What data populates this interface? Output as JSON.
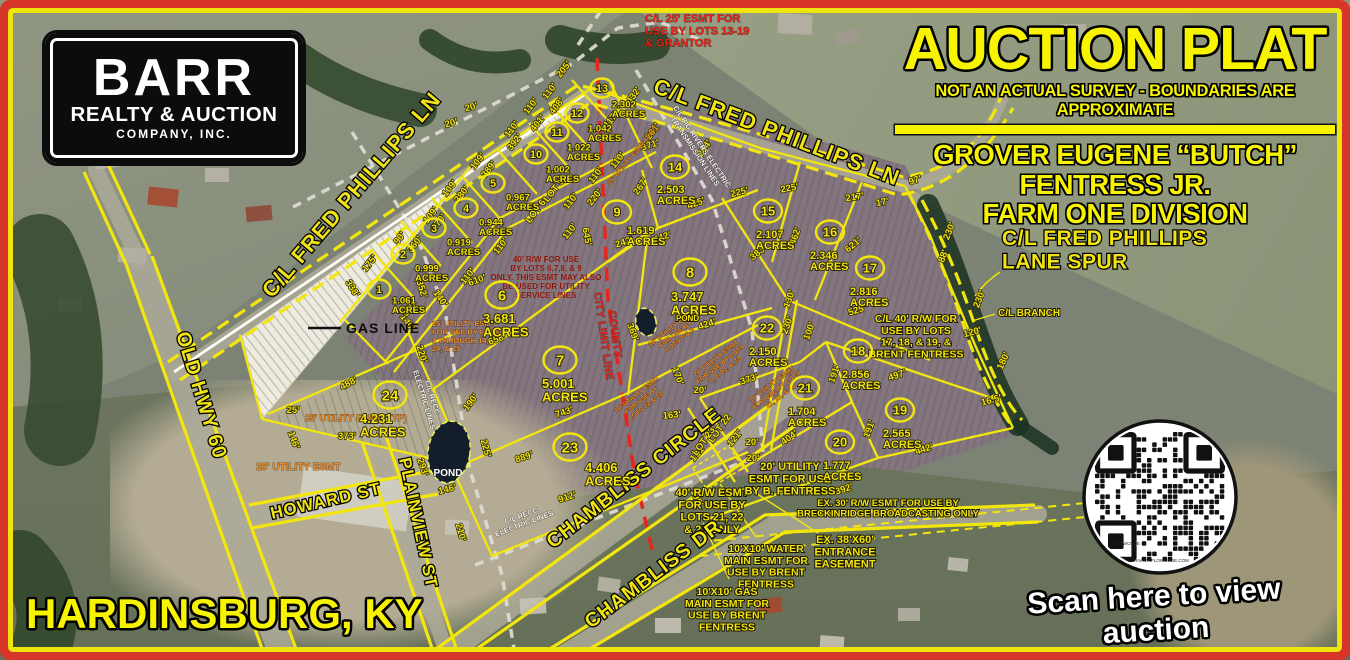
{
  "frame": {
    "border_color": "#d8352a",
    "inner_border_color": "#efe40c"
  },
  "logo": {
    "line1": "BARR",
    "line2": "REALTY & AUCTION",
    "line3": "COMPANY, INC."
  },
  "title_block": {
    "title": "AUCTION PLAT",
    "subtitle": "NOT AN ACTUAL SURVEY - BOUNDARIES ARE APPROXIMATE",
    "owner_line1": "GROVER EUGENE “BUTCH” FENTRESS JR.",
    "owner_line2": "FARM ONE DIVISION",
    "accent_color": "#f8f400"
  },
  "labels": {
    "city": "HARDINSBURG, KY",
    "scan_caption": "Scan here to view auction",
    "qr_brand": "FLOWCODE",
    "qr_privacy": "PRIVACY.FLOWCODE.COM"
  },
  "road_labels": [
    [
      "C/L FRED PHILLIPS LN",
      272,
      299,
      -49.5,
      22
    ],
    [
      "C/L FRED PHILLIPS LN",
      652,
      92,
      21,
      22
    ],
    [
      "OLD HWY 60",
      176,
      334,
      73,
      20
    ],
    [
      "HOWARD ST",
      272,
      519,
      -13,
      17
    ],
    [
      "PLAINVIEW ST",
      399,
      459,
      78,
      17
    ],
    [
      "CHAMBLISS CIRCLE",
      553,
      549,
      -38,
      20
    ],
    [
      "CHAMBLISS DR",
      591,
      629,
      -37,
      20
    ]
  ],
  "lots": [
    [
      "1",
      "1.061",
      379,
      289,
      392,
      294,
      "s"
    ],
    [
      "2",
      "0.999",
      403,
      254,
      415,
      262,
      "s"
    ],
    [
      "3",
      "0.919",
      434,
      228,
      447,
      236,
      "s"
    ],
    [
      "4",
      "0.944",
      466,
      208,
      479,
      216,
      "s"
    ],
    [
      "5",
      "0.967",
      493,
      183,
      506,
      191,
      "s"
    ],
    [
      "6",
      "3.681",
      502,
      295,
      483,
      310,
      "b"
    ],
    [
      "7",
      "5.001",
      560,
      360,
      542,
      375,
      "b"
    ],
    [
      "8",
      "3.747",
      690,
      272,
      671,
      288,
      "b"
    ],
    [
      "9",
      "1.619",
      617,
      212,
      627,
      223,
      "m"
    ],
    [
      "10",
      "1.002",
      536,
      154,
      546,
      163,
      "s"
    ],
    [
      "11",
      "1.022",
      557,
      132,
      567,
      141,
      "s"
    ],
    [
      "12",
      "1.042",
      577,
      113,
      588,
      122,
      "s"
    ],
    [
      "13",
      "2.302",
      602,
      88,
      612,
      98,
      "s"
    ],
    [
      "14",
      "2.503",
      675,
      167,
      657,
      182,
      "m"
    ],
    [
      "15",
      "2.107",
      768,
      211,
      756,
      227,
      "m"
    ],
    [
      "16",
      "2.346",
      830,
      232,
      810,
      248,
      "m"
    ],
    [
      "17",
      "2.816",
      870,
      268,
      850,
      284,
      "m"
    ],
    [
      "18",
      "2.856",
      858,
      351,
      842,
      367,
      "m"
    ],
    [
      "19",
      "2.565",
      900,
      410,
      883,
      426,
      "m"
    ],
    [
      "20",
      "1.777",
      840,
      442,
      823,
      458,
      "m"
    ],
    [
      "21",
      "1.704",
      805,
      388,
      788,
      404,
      "m"
    ],
    [
      "22",
      "2.150",
      767,
      328,
      749,
      344,
      "m"
    ],
    [
      "23",
      "4.406",
      570,
      447,
      585,
      459,
      "b"
    ],
    [
      "24",
      "4.231",
      390,
      395,
      360,
      410,
      "b"
    ]
  ],
  "dims": [
    [
      "20'",
      472,
      110,
      -15
    ],
    [
      "20'",
      452,
      126,
      -15
    ],
    [
      "205'",
      566,
      71,
      -52
    ],
    [
      "175'",
      372,
      265,
      -52
    ],
    [
      "338'",
      350,
      290,
      58
    ],
    [
      "90'",
      402,
      240,
      -52
    ],
    [
      "360'",
      417,
      246,
      -52
    ],
    [
      "352'",
      419,
      290,
      72
    ],
    [
      "140'",
      405,
      324,
      55
    ],
    [
      "140'",
      438,
      300,
      55
    ],
    [
      "220'",
      419,
      355,
      72
    ],
    [
      "488'",
      350,
      386,
      -28
    ],
    [
      "25'",
      293,
      413,
      0
    ],
    [
      "146'",
      291,
      441,
      70
    ],
    [
      "373'",
      347,
      439,
      0
    ],
    [
      "293'",
      420,
      468,
      72
    ],
    [
      "109'",
      433,
      217,
      -52
    ],
    [
      "370'",
      441,
      224,
      -52
    ],
    [
      "109'",
      452,
      190,
      -52
    ],
    [
      "380'",
      464,
      196,
      -52
    ],
    [
      "109'",
      480,
      163,
      -52
    ],
    [
      "389'",
      491,
      171,
      -52
    ],
    [
      "110'",
      514,
      131,
      -52
    ],
    [
      "392'",
      517,
      144,
      -52
    ],
    [
      "110'",
      533,
      108,
      -52
    ],
    [
      "401'",
      540,
      125,
      -52
    ],
    [
      "110'",
      552,
      93,
      -52
    ],
    [
      "408'",
      559,
      108,
      -52
    ],
    [
      "417'",
      613,
      122,
      -52
    ],
    [
      "432'",
      636,
      97,
      -55
    ],
    [
      "261'",
      655,
      133,
      -55
    ],
    [
      "371'",
      651,
      148,
      -18
    ],
    [
      "294'",
      707,
      150,
      -55
    ],
    [
      "110'",
      620,
      162,
      -52
    ],
    [
      "110'",
      598,
      177,
      -52
    ],
    [
      "220'",
      597,
      199,
      -52
    ],
    [
      "110'",
      573,
      203,
      -52
    ],
    [
      "110'",
      572,
      233,
      -52
    ],
    [
      "645'",
      584,
      237,
      80
    ],
    [
      "242'",
      625,
      245,
      -18
    ],
    [
      "110'",
      503,
      248,
      -52
    ],
    [
      "110'",
      470,
      278,
      -52
    ],
    [
      "610'",
      478,
      283,
      -20
    ],
    [
      "140'",
      412,
      310,
      -52
    ],
    [
      "658'",
      498,
      342,
      -20
    ],
    [
      "190'",
      473,
      404,
      -52
    ],
    [
      "225'",
      483,
      449,
      75
    ],
    [
      "210'",
      458,
      533,
      75
    ],
    [
      "146'",
      448,
      492,
      -15
    ],
    [
      "889'",
      525,
      460,
      -18
    ],
    [
      "912'",
      568,
      500,
      -18
    ],
    [
      "743'",
      565,
      415,
      -18
    ],
    [
      "369'",
      630,
      333,
      70
    ],
    [
      "424'",
      708,
      327,
      -18
    ],
    [
      "425'",
      697,
      206,
      -20
    ],
    [
      "267'",
      643,
      188,
      -55
    ],
    [
      "442'",
      663,
      240,
      -18
    ],
    [
      "225'",
      740,
      195,
      -14
    ],
    [
      "225'",
      790,
      191,
      -10
    ],
    [
      "217'",
      855,
      200,
      -8
    ],
    [
      "17'",
      883,
      205,
      -12
    ],
    [
      "97'",
      916,
      183,
      -18
    ],
    [
      "462'",
      798,
      237,
      -70
    ],
    [
      "383'",
      760,
      255,
      -40
    ],
    [
      "621'",
      855,
      247,
      -40
    ],
    [
      "130'",
      792,
      300,
      -70
    ],
    [
      "230'",
      790,
      326,
      -70
    ],
    [
      "100'",
      812,
      332,
      -70
    ],
    [
      "525'",
      858,
      313,
      -18
    ],
    [
      "230'",
      952,
      232,
      -68
    ],
    [
      "88'",
      946,
      257,
      -70
    ],
    [
      "230'",
      982,
      300,
      -68
    ],
    [
      "120'",
      973,
      335,
      -15
    ],
    [
      "180'",
      1006,
      362,
      -65
    ],
    [
      "16.5'",
      992,
      403,
      -15
    ],
    [
      "373'",
      750,
      382,
      -18
    ],
    [
      "404'",
      791,
      440,
      -35
    ],
    [
      "191'",
      837,
      375,
      -70
    ],
    [
      "191'",
      872,
      430,
      -70
    ],
    [
      "497'",
      898,
      378,
      -18
    ],
    [
      "442'",
      925,
      452,
      -18
    ],
    [
      "392'",
      845,
      492,
      -18
    ],
    [
      "121'",
      737,
      440,
      -50
    ],
    [
      "121'",
      700,
      455,
      -50
    ],
    [
      "163'",
      672,
      418,
      -5
    ],
    [
      "170'",
      675,
      377,
      70
    ],
    [
      "195'",
      694,
      499,
      65
    ],
    [
      "20'",
      700,
      393,
      0
    ],
    [
      "20'",
      752,
      445,
      0
    ],
    [
      "20'",
      753,
      461,
      0
    ],
    [
      "LOT 9",
      556,
      192,
      -52
    ],
    [
      "LOT 6",
      538,
      213,
      -52
    ],
    [
      "LOT 22",
      722,
      430,
      -55
    ],
    [
      "LOT 23",
      706,
      443,
      -55
    ]
  ],
  "notes": [
    {
      "t": "C/L 25' ESMT FOR\nUSE BY LOTS 13-19\n& GRANTOR",
      "x": 645,
      "y": 22,
      "cls": "red",
      "size": 11,
      "anchor": "start"
    },
    {
      "t": "40' R/W FOR USE\nBY LOTS 6,7,8, & 9\nONLY. THIS ESMT MAY ALSO\nBE USED FOR UTILITY\nSERVICE LINES",
      "x": 546,
      "y": 262,
      "cls": "darkred",
      "size": 8,
      "anchor": "middle"
    },
    {
      "t": "25' UTILITY ESMT\nFOR USE BY LOTS\n1 THROUGH 14,\n24, & 25",
      "x": 432,
      "y": 326,
      "cls": "orange",
      "size": 7.5,
      "anchor": "start"
    },
    {
      "t": "25' UTILITY ESMT (TYP)",
      "x": 305,
      "y": 421,
      "cls": "orange",
      "size": 9,
      "anchor": "start"
    },
    {
      "t": "25' UTILITY ESMT",
      "x": 256,
      "y": 470,
      "cls": "orange",
      "size": 10,
      "anchor": "start"
    },
    {
      "t": "10' UTILITY ESMT\nFOR USE BY\nLOTS 7 & 8",
      "x": 672,
      "y": 330,
      "cls": "orange",
      "size": 6.5,
      "rot": -38,
      "anchor": "middle"
    },
    {
      "t": "20' UTILITY ESMT\nFOR USE BY LOTS\n7, 8, 22, & 23",
      "x": 717,
      "y": 360,
      "cls": "orange",
      "size": 6.5,
      "rot": -38,
      "anchor": "middle"
    },
    {
      "t": "10' UTILITY ESMT\nFOR USE BY LOTS\n21, 22, & 23",
      "x": 773,
      "y": 386,
      "cls": "orange",
      "size": 6.5,
      "rot": -38,
      "anchor": "middle"
    },
    {
      "t": "10' UTILITY ESMT\nFOR USE BY\nLOTS 22 & 23",
      "x": 638,
      "y": 396,
      "cls": "orange",
      "size": 6.5,
      "rot": -38,
      "anchor": "middle"
    },
    {
      "t": "25' UTILITY ESMT (TYP)",
      "x": 634,
      "y": 157,
      "cls": "orange",
      "size": 6.5,
      "rot": -50,
      "anchor": "middle"
    },
    {
      "t": "40' R/W ESMT\nFOR USE BY\nLOTS 21, 22\n& 23 ONLY",
      "x": 712,
      "y": 496,
      "cls": "yellow-note",
      "size": 11,
      "anchor": "middle"
    },
    {
      "t": "20' UTILITY\nESMT FOR USE\nBY B. FENTRESS",
      "x": 790,
      "y": 470,
      "cls": "yellow-note",
      "size": 11,
      "anchor": "middle"
    },
    {
      "t": "10'X10' WATER\nMAIN ESMT FOR\nUSE BY BRENT\nFENTRESS",
      "x": 766,
      "y": 552,
      "cls": "yellow-note",
      "size": 10.5,
      "anchor": "middle"
    },
    {
      "t": "10'X10' GAS\nMAIN ESMT FOR\nUSE BY BRENT\nFENTRESS",
      "x": 727,
      "y": 595,
      "cls": "yellow-note",
      "size": 10.5,
      "anchor": "middle"
    },
    {
      "t": "EX. 38'X60'\nENTRANCE\nEASEMENT",
      "x": 845,
      "y": 543,
      "cls": "yellow-note",
      "size": 11,
      "anchor": "middle"
    },
    {
      "t": "EX. 30' R/W ESMT FOR USE BY\nBRECKINRIDGE BROADCASTING ONLY",
      "x": 888,
      "y": 506,
      "cls": "yellow-note",
      "size": 9.5,
      "anchor": "middle"
    },
    {
      "t": "C/L 40' R/W FOR\nUSE BY LOTS\n17, 18, & 19, &\nBRENT FENTRESS",
      "x": 916,
      "y": 322,
      "cls": "yellow-note",
      "size": 10.5,
      "anchor": "middle"
    },
    {
      "t": "C/L BRANCH",
      "x": 998,
      "y": 316,
      "cls": "yellow-note",
      "size": 10,
      "anchor": "start"
    },
    {
      "t": "C/L FRED PHILLIPS\nLANE SPUR",
      "x": 1002,
      "y": 245,
      "cls": "yellow-big",
      "size": 21,
      "anchor": "start"
    },
    {
      "t": "C/L RECC\nELECTRIC LINES",
      "x": 430,
      "y": 398,
      "cls": "white",
      "size": 7.5,
      "rot": 73,
      "anchor": "middle"
    },
    {
      "t": "C/L RECC\nELECTRIC LINES",
      "x": 522,
      "y": 518,
      "cls": "white",
      "size": 7.5,
      "rot": -21,
      "anchor": "middle"
    },
    {
      "t": "C/L BIG RIVERS ELECTRIC\nTRANSMISSION LINES",
      "x": 700,
      "y": 148,
      "cls": "white",
      "size": 7.5,
      "rot": 56,
      "anchor": "middle"
    },
    {
      "t": "COUNTY\nCITY LIMIT LINE",
      "x": 612,
      "y": 335,
      "cls": "red-big",
      "size": 10.5,
      "rot": 82,
      "anchor": "middle"
    },
    {
      "t": "GAS LINE",
      "x": 346,
      "y": 333,
      "cls": "black",
      "size": 14,
      "anchor": "start"
    },
    {
      "t": "POND",
      "x": 676,
      "y": 321,
      "cls": "yellow-note",
      "size": 8,
      "anchor": "start"
    },
    {
      "t": "POND",
      "x": 448,
      "y": 476,
      "cls": "white-big",
      "size": 10,
      "anchor": "middle"
    }
  ]
}
